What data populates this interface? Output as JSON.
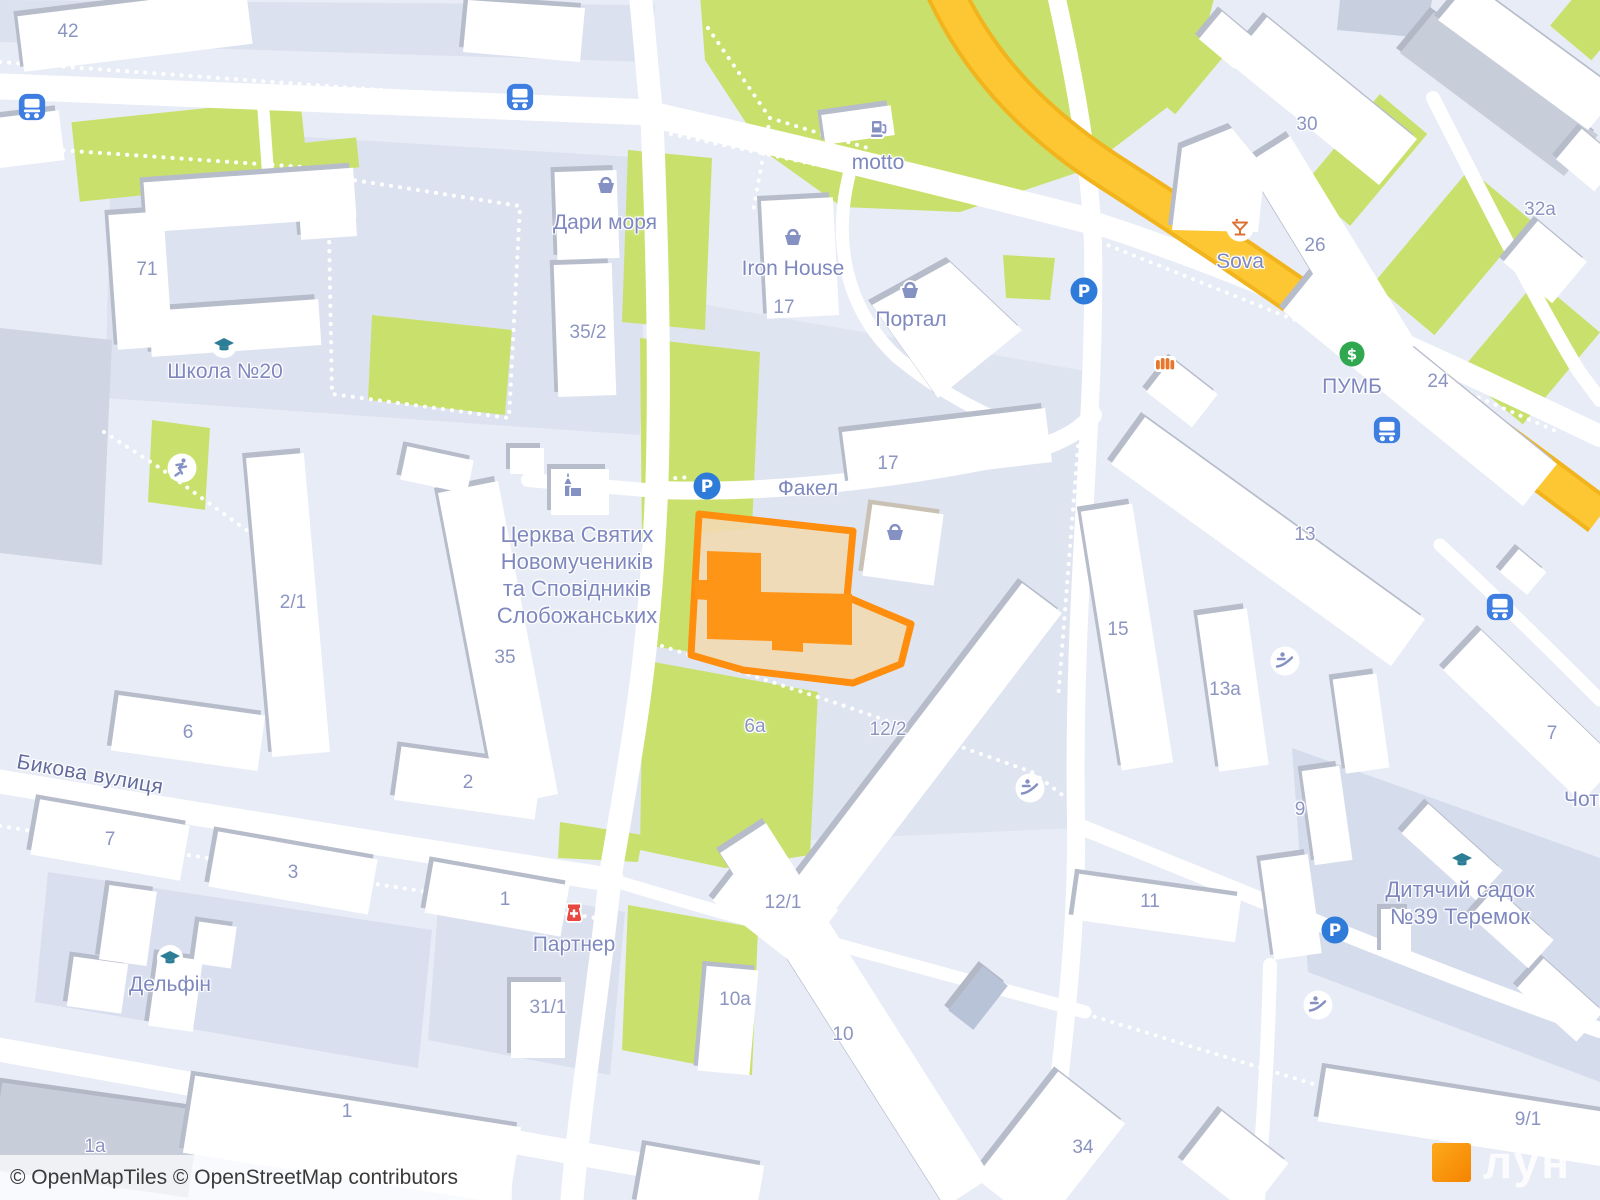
{
  "map": {
    "attribution": {
      "text": "© OpenMapTiles © OpenStreetMap contributors"
    },
    "watermark": {
      "brand": "лун"
    },
    "palette": {
      "highlight_stroke": "#FF8E0F",
      "highlight_fill": "#F2D9B2",
      "highlight_building": "#FF9517",
      "road_major": "#FBC431",
      "green_area": "#C9E16C",
      "poi_text": "#7E88BF",
      "street_text": "#636C9E",
      "bus_icon_blue": "#3E7EE1",
      "parking_blue": "#2E7BD9",
      "education_teal": "#2B7E96",
      "bank_green": "#2FA850",
      "pharmacy_red": "#E8483F",
      "bar_orange": "#DD7034"
    },
    "labels": [
      {
        "id": "hn-42",
        "t": "42",
        "x": 68,
        "y": 32,
        "k": "num"
      },
      {
        "id": "hn-71",
        "t": "71",
        "x": 147,
        "y": 270,
        "k": "num"
      },
      {
        "id": "school-20",
        "t": "Школа №20",
        "x": 225,
        "y": 372,
        "k": "poi"
      },
      {
        "id": "dary-morya",
        "t": "Дари моря",
        "x": 605,
        "y": 223,
        "k": "poi"
      },
      {
        "id": "hn-35-2",
        "t": "35/2",
        "x": 588,
        "y": 333,
        "k": "num"
      },
      {
        "id": "iron-house",
        "t": "Iron House",
        "x": 793,
        "y": 269,
        "k": "poi"
      },
      {
        "id": "hn-17-iron",
        "t": "17",
        "x": 784,
        "y": 308,
        "k": "num"
      },
      {
        "id": "portal",
        "t": "Портал",
        "x": 911,
        "y": 320,
        "k": "poi"
      },
      {
        "id": "motto",
        "t": "motto",
        "x": 878,
        "y": 163,
        "k": "poi"
      },
      {
        "id": "hn-30",
        "t": "30",
        "x": 1307,
        "y": 125,
        "k": "num"
      },
      {
        "id": "sova",
        "t": "Sova",
        "x": 1240,
        "y": 262,
        "k": "poi"
      },
      {
        "id": "hn-26",
        "t": "26",
        "x": 1315,
        "y": 246,
        "k": "num"
      },
      {
        "id": "hn-32a",
        "t": "32a",
        "x": 1540,
        "y": 210,
        "k": "num"
      },
      {
        "id": "pumb",
        "t": "ПУМБ",
        "x": 1352,
        "y": 387,
        "k": "poi"
      },
      {
        "id": "hn-24",
        "t": "24",
        "x": 1438,
        "y": 382,
        "k": "num"
      },
      {
        "id": "church",
        "t": "Церква Святих\nНовомучеників\nта Сповідників\nСлобожанських",
        "x": 577,
        "y": 575,
        "k": "poi-lg"
      },
      {
        "id": "fakel",
        "t": "Факел",
        "x": 808,
        "y": 489,
        "k": "poi"
      },
      {
        "id": "hn-17-fakel",
        "t": "17",
        "x": 888,
        "y": 464,
        "k": "num"
      },
      {
        "id": "hn-2-1",
        "t": "2/1",
        "x": 293,
        "y": 603,
        "k": "num"
      },
      {
        "id": "hn-35",
        "t": "35",
        "x": 505,
        "y": 658,
        "k": "num"
      },
      {
        "id": "hn-15",
        "t": "15",
        "x": 1118,
        "y": 630,
        "k": "num"
      },
      {
        "id": "hn-13",
        "t": "13",
        "x": 1305,
        "y": 535,
        "k": "num"
      },
      {
        "id": "hn-13a",
        "t": "13a",
        "x": 1225,
        "y": 690,
        "k": "num"
      },
      {
        "id": "hn-6",
        "t": "6",
        "x": 188,
        "y": 733,
        "k": "num"
      },
      {
        "id": "bykova-street",
        "t": "Бикова вулиця",
        "x": 90,
        "y": 775,
        "k": "street",
        "r": 10
      },
      {
        "id": "hn-2",
        "t": "2",
        "x": 468,
        "y": 783,
        "k": "num"
      },
      {
        "id": "hn-7-left",
        "t": "7",
        "x": 110,
        "y": 840,
        "k": "num"
      },
      {
        "id": "hn-3",
        "t": "3",
        "x": 293,
        "y": 873,
        "k": "num"
      },
      {
        "id": "hn-1-partner",
        "t": "1",
        "x": 505,
        "y": 900,
        "k": "num"
      },
      {
        "id": "partner",
        "t": "Партнер",
        "x": 574,
        "y": 945,
        "k": "poi"
      },
      {
        "id": "delfin",
        "t": "Дельфін",
        "x": 170,
        "y": 985,
        "k": "poi"
      },
      {
        "id": "hn-31-1",
        "t": "31/1",
        "x": 548,
        "y": 1008,
        "k": "num"
      },
      {
        "id": "hn-12-2",
        "t": "12/2",
        "x": 888,
        "y": 730,
        "k": "num"
      },
      {
        "id": "hn-6a",
        "t": "6a",
        "x": 755,
        "y": 727,
        "k": "num"
      },
      {
        "id": "hn-12-1",
        "t": "12/1",
        "x": 783,
        "y": 903,
        "k": "num"
      },
      {
        "id": "hn-10a",
        "t": "10a",
        "x": 735,
        "y": 1000,
        "k": "num"
      },
      {
        "id": "hn-10",
        "t": "10",
        "x": 843,
        "y": 1035,
        "k": "num"
      },
      {
        "id": "hn-9",
        "t": "9",
        "x": 1300,
        "y": 810,
        "k": "num"
      },
      {
        "id": "hn-11",
        "t": "11",
        "x": 1150,
        "y": 902,
        "k": "num"
      },
      {
        "id": "kindergarten",
        "t": "Дитячий садок\n№39 Теремок",
        "x": 1460,
        "y": 903,
        "k": "poi-lg"
      },
      {
        "id": "hn-7-right",
        "t": "7",
        "x": 1552,
        "y": 734,
        "k": "num"
      },
      {
        "id": "chotyry-clipped",
        "t": "Чотири",
        "x": 1599,
        "y": 800,
        "k": "poi"
      },
      {
        "id": "hn-34",
        "t": "34",
        "x": 1083,
        "y": 1148,
        "k": "num"
      },
      {
        "id": "hn-9-1",
        "t": "9/1",
        "x": 1528,
        "y": 1120,
        "k": "num"
      },
      {
        "id": "hn-1a",
        "t": "1a",
        "x": 95,
        "y": 1147,
        "k": "num"
      },
      {
        "id": "hn-1-bottom",
        "t": "1",
        "x": 347,
        "y": 1112,
        "k": "num"
      }
    ],
    "icons": [
      {
        "type": "bus",
        "x": 32,
        "y": 107
      },
      {
        "type": "bus",
        "x": 520,
        "y": 97
      },
      {
        "type": "bus",
        "x": 1387,
        "y": 430
      },
      {
        "type": "bus",
        "x": 1500,
        "y": 607
      },
      {
        "type": "parking",
        "x": 707,
        "y": 486
      },
      {
        "type": "parking",
        "x": 1084,
        "y": 291
      },
      {
        "type": "parking",
        "x": 1335,
        "y": 930
      },
      {
        "type": "school",
        "x": 224,
        "y": 345
      },
      {
        "type": "school",
        "x": 170,
        "y": 958
      },
      {
        "type": "school",
        "x": 1462,
        "y": 860
      },
      {
        "type": "basket",
        "x": 606,
        "y": 186
      },
      {
        "type": "basket",
        "x": 793,
        "y": 238
      },
      {
        "type": "basket",
        "x": 910,
        "y": 291
      },
      {
        "type": "basket",
        "x": 895,
        "y": 533
      },
      {
        "type": "fuel",
        "x": 880,
        "y": 130
      },
      {
        "type": "cocktail",
        "x": 1240,
        "y": 228
      },
      {
        "type": "bank",
        "x": 1352,
        "y": 354
      },
      {
        "type": "pharmacy",
        "x": 574,
        "y": 914
      },
      {
        "type": "church",
        "x": 572,
        "y": 488
      },
      {
        "type": "kiosk",
        "x": 1165,
        "y": 366
      },
      {
        "type": "playground",
        "x": 1285,
        "y": 661
      },
      {
        "type": "playground",
        "x": 1030,
        "y": 788
      },
      {
        "type": "playground",
        "x": 1318,
        "y": 1005
      },
      {
        "type": "sport",
        "x": 182,
        "y": 468
      }
    ]
  }
}
